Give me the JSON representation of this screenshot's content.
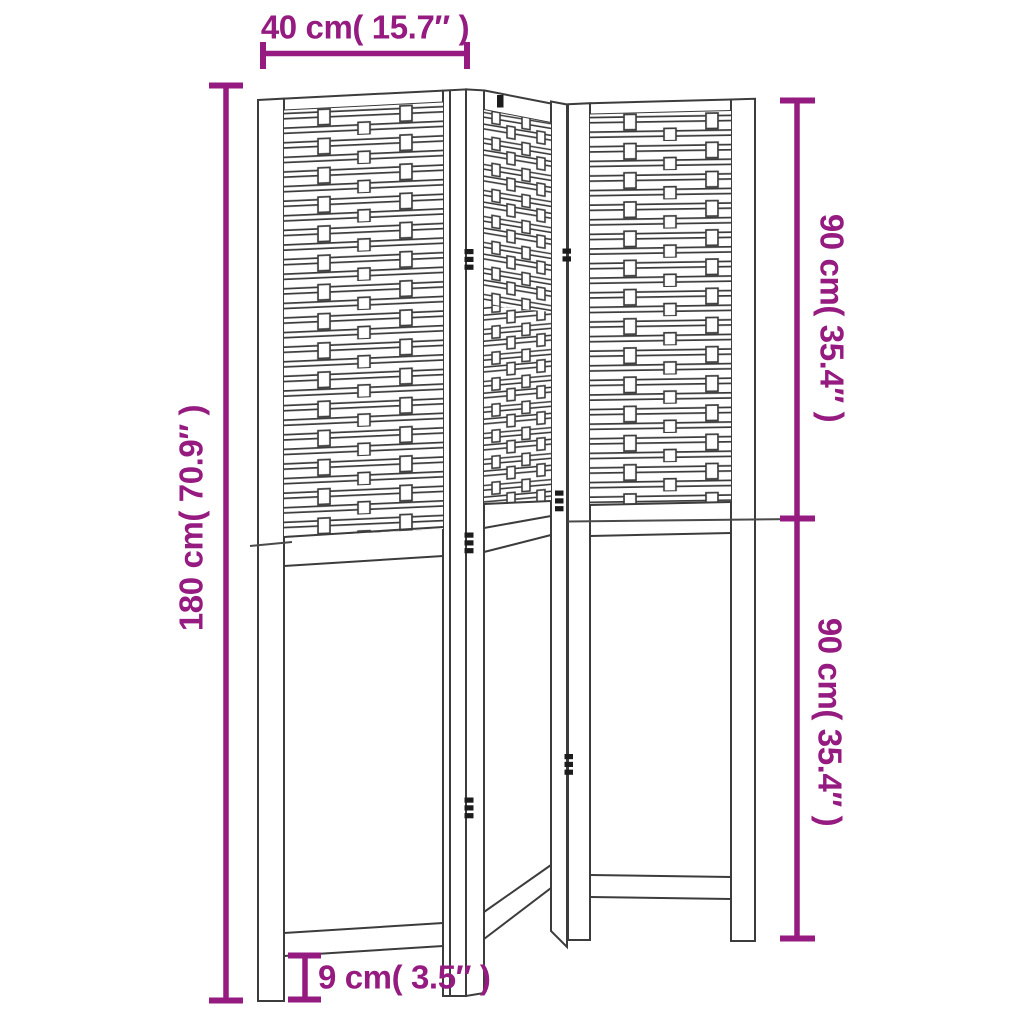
{
  "diagram": {
    "subject": "3-panel folding room divider screen dimension drawing",
    "line_color": "#3c3c3c",
    "dimension_color": "#951b81",
    "labels": {
      "panel_width": "40 cm( 15.7″ )",
      "total_height": "180 cm( 70.9″ )",
      "upper_section_height": "90 cm( 35.4″ )",
      "lower_section_height": "90 cm( 35.4″ )",
      "leg_height": "9 cm( 3.5″ )"
    }
  }
}
